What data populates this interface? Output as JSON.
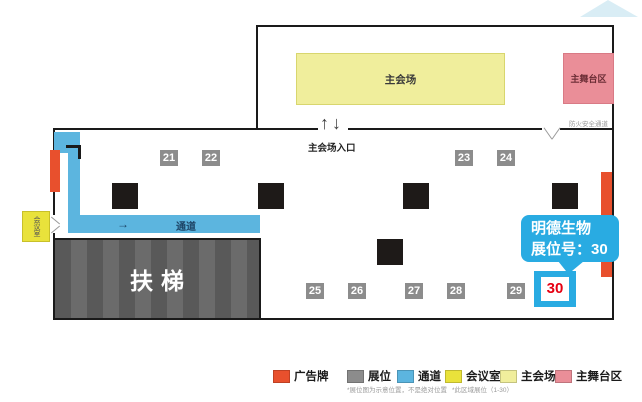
{
  "colors": {
    "billboard": "#E8502D",
    "booth": "#8C8C8C",
    "aisle": "#5CB5DF",
    "meeting_room": "#E9E23B",
    "main_hall": "#F0EE9C",
    "stage": "#EA8E98",
    "highlight": "#29ABE2",
    "booth30_number": "#E60012",
    "wall": "#1A1A1A"
  },
  "upper_hall": {
    "main_hall_label": "主会场",
    "stage_label": "主舞台区",
    "fire_exit_label": "防火安全通道",
    "entrance_label": "主会场入口",
    "up_arrow": "↑",
    "down_arrow": "↓"
  },
  "lower_hall": {
    "aisle_label": "通道",
    "aisle_arrow": "→",
    "escalator_label": "扶梯",
    "meeting_room_label": "会议室"
  },
  "booths": {
    "row1": [
      "21",
      "22",
      "23",
      "24"
    ],
    "row2": [
      "25",
      "26",
      "27",
      "28",
      "29"
    ],
    "highlight": "30"
  },
  "callout": {
    "line1": "明德生物",
    "line2": "展位号：30"
  },
  "legend": {
    "items": [
      {
        "label": "广告牌",
        "color": "#E8502D"
      },
      {
        "label": "展位",
        "color": "#8C8C8C"
      },
      {
        "label": "通道",
        "color": "#5CB5DF"
      },
      {
        "label": "会议室",
        "color": "#E9E23B"
      },
      {
        "label": "主会场",
        "color": "#F0EE9C"
      },
      {
        "label": "主舞台区",
        "color": "#EA8E98"
      }
    ],
    "note1": "*展位图为示意位置，不是绝对位置",
    "note2": "*此区域展位（1-30）"
  }
}
